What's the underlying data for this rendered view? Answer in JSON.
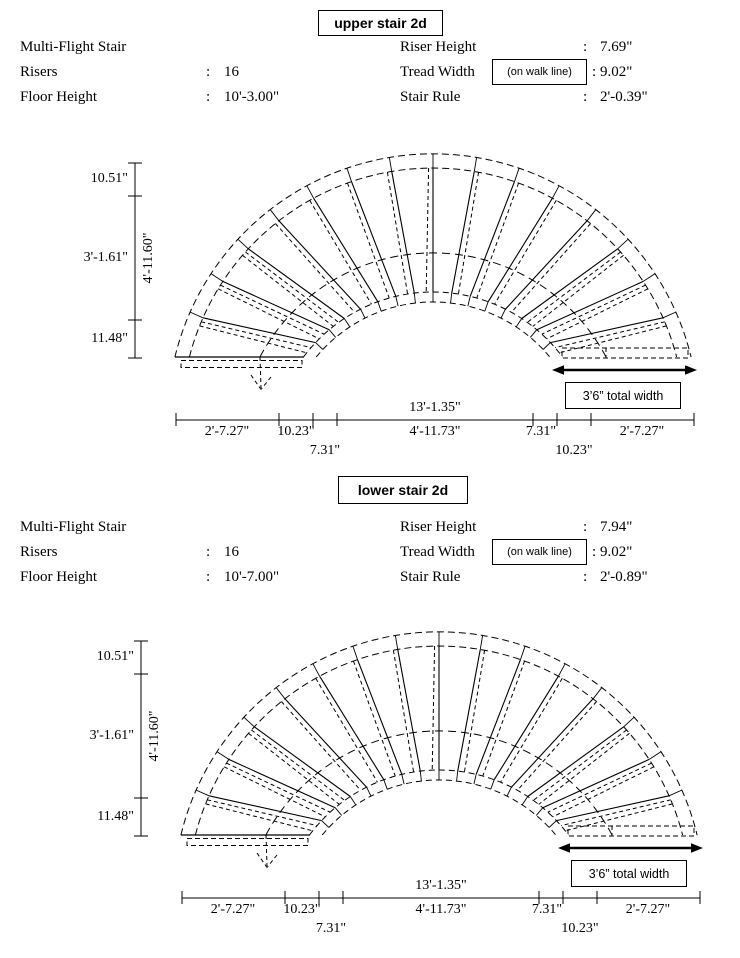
{
  "diagrams": [
    {
      "title": "upper stair 2d",
      "info_left": [
        {
          "label": "Multi-Flight Stair",
          "sep": "",
          "value": ""
        },
        {
          "label": "Risers",
          "sep": ":",
          "value": "16"
        },
        {
          "label": "Floor Height",
          "sep": ":",
          "value": "10'-3.00\""
        }
      ],
      "info_right": [
        {
          "label": "Riser Height",
          "sep": ":",
          "value": "7.69\""
        },
        {
          "label": "Tread Width",
          "note": "(on walk line)",
          "sep": ":",
          "value": "9.02\""
        },
        {
          "label": "Stair Rule",
          "sep": ":",
          "value": "2'-0.39\""
        }
      ],
      "vdim": {
        "seg1": "10.51\"",
        "seg2": "3'-1.61\"",
        "seg3": "11.48\"",
        "overall": "4'-11.60\""
      },
      "hdim": {
        "overall": "13'-1.35\"",
        "row1": [
          "2'-7.27\"",
          "10.23\"",
          "4'-11.73\"",
          "7.31\"",
          "2'-7.27\""
        ],
        "row2": [
          "7.31\"",
          "10.23\""
        ]
      },
      "total_width": "3’6” total width"
    },
    {
      "title": "lower stair 2d",
      "info_left": [
        {
          "label": "Multi-Flight Stair",
          "sep": "",
          "value": ""
        },
        {
          "label": "Risers",
          "sep": ":",
          "value": "16"
        },
        {
          "label": "Floor Height",
          "sep": ":",
          "value": "10'-7.00\""
        }
      ],
      "info_right": [
        {
          "label": "Riser Height",
          "sep": ":",
          "value": "7.94\""
        },
        {
          "label": "Tread Width",
          "note": "(on walk line)",
          "sep": ":",
          "value": "9.02\""
        },
        {
          "label": "Stair Rule",
          "sep": ":",
          "value": "2'-0.89\""
        }
      ],
      "vdim": {
        "seg1": "10.51\"",
        "seg2": "3'-1.61\"",
        "seg3": "11.48\"",
        "overall": "4'-11.60\""
      },
      "hdim": {
        "overall": "13'-1.35\"",
        "row1": [
          "2'-7.27\"",
          "10.23\"",
          "4'-11.73\"",
          "7.31\"",
          "2'-7.27\""
        ],
        "row2": [
          "7.31\"",
          "10.23\""
        ]
      },
      "total_width": "3’6” total width"
    }
  ]
}
